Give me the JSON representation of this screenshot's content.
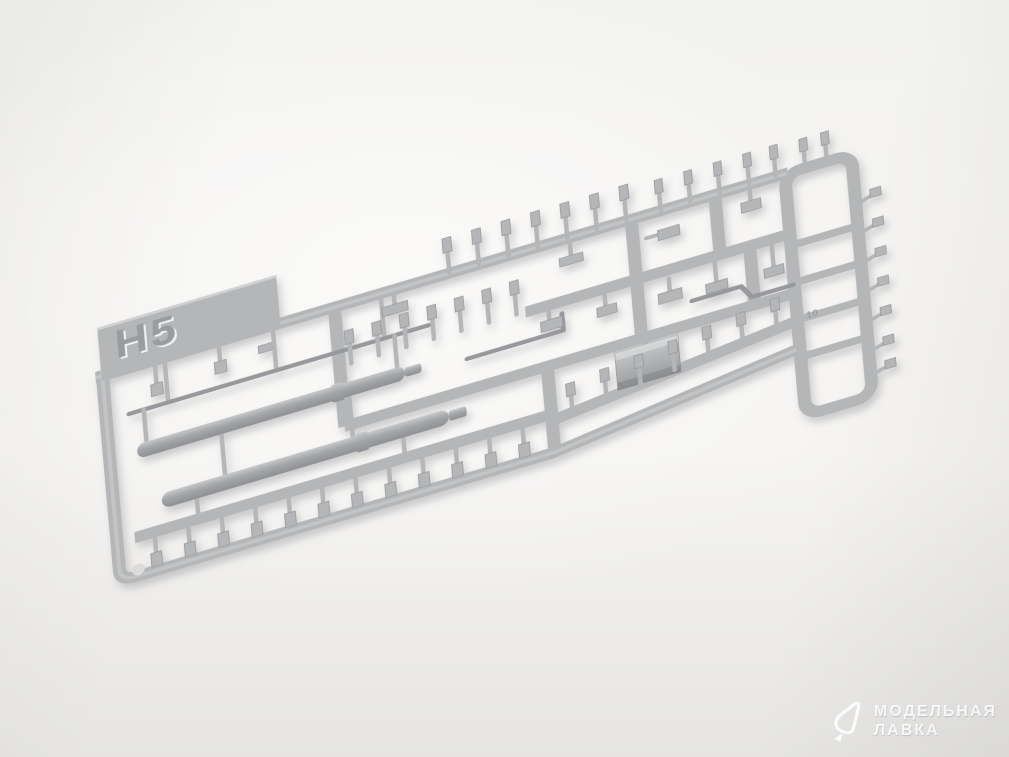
{
  "scene": {
    "description": "Product photograph of a light-gray injection-molded plastic model kit sprue (parts frame) lying diagonally on a white studio background",
    "subject": "plastic sprue with small detail parts, two gun barrels, a stowage box and bracket parts"
  },
  "sprue": {
    "label": "H5",
    "part_number": "10"
  },
  "watermark": {
    "line1": "МОДЕЛЬНАЯ",
    "line2": "ЛАВКА"
  },
  "colors": {
    "background-top": "#f2f2f0",
    "background-center": "#f5f4f2",
    "background-bottom": "#e6e5e3",
    "sprue-base": "#b4b6b8",
    "sprue-light": "#cfd1d2",
    "sprue-dark": "#97999c",
    "barrel-mid": "#a3a5a8",
    "shadow": "#85868a",
    "label-emboss": "#9a9ca0",
    "watermark": "rgba(255,255,255,0.85)"
  }
}
